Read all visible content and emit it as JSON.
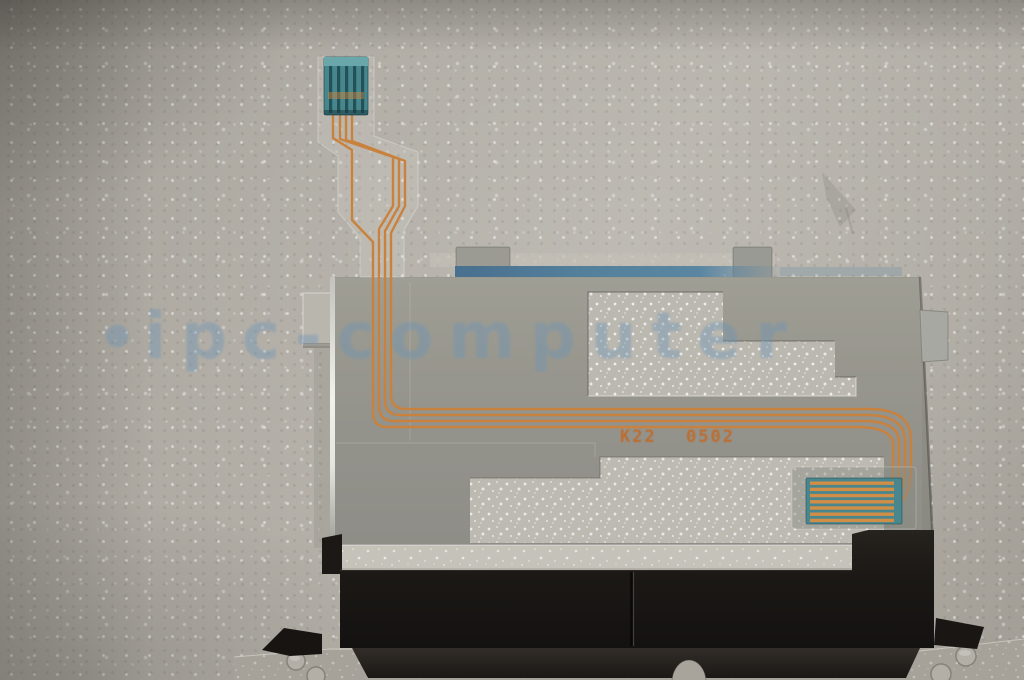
{
  "photo": {
    "description": "Laptop touchpad button-board assembly with translucent flex ribbon cable lying on white packing foam",
    "markings": {
      "left_code": "K22",
      "right_code": "0502"
    },
    "watermark": {
      "bullet": "●",
      "text": "ipc-computer"
    },
    "colors": {
      "foam": "#b3afa7",
      "plate": "#929189",
      "film_window": "#bab7af",
      "trace": "#c8823e",
      "connector_teal": "#48868e",
      "adhesive_blue": "#54809c",
      "button_black": "#1b1815",
      "bracket": "#a6a299",
      "marking_orange": "#c06a28",
      "watermark_blue": "#6c94b6"
    }
  }
}
